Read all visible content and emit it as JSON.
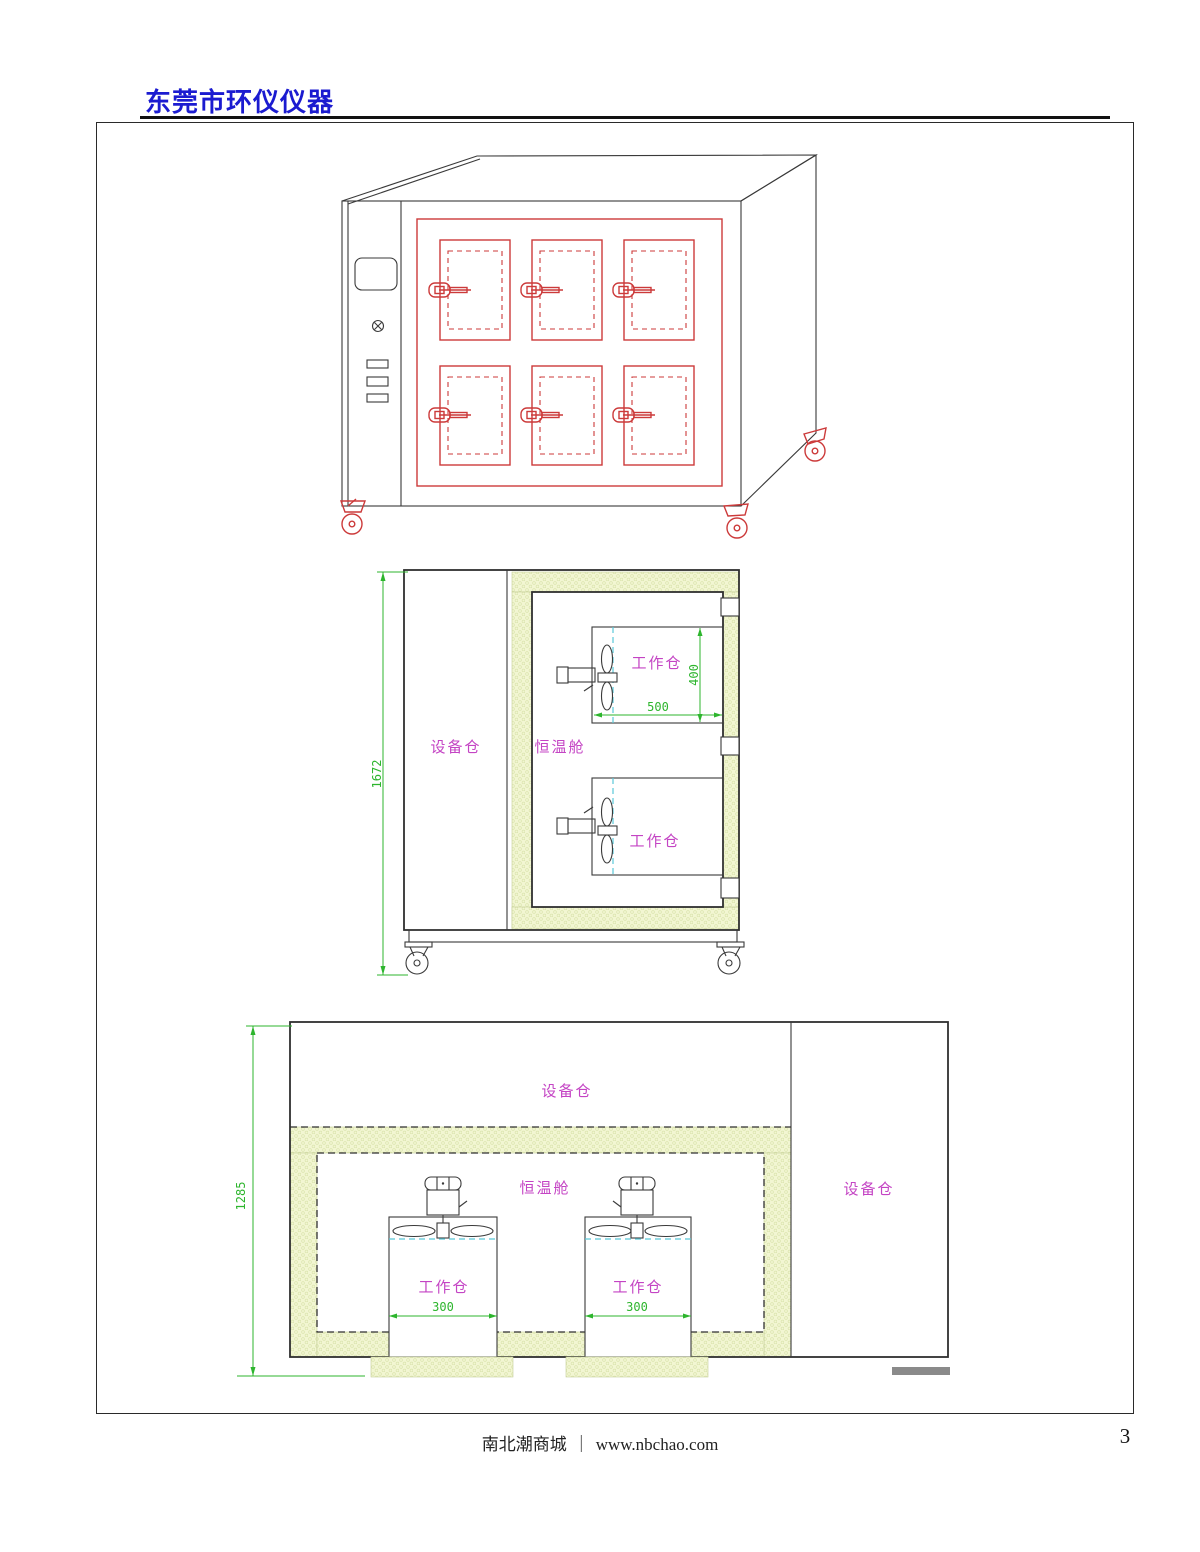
{
  "header": {
    "brand": "东莞市环仪仪器"
  },
  "side_section": {
    "dim_overall_height": "1672",
    "equipment_bay_label": "设备仓",
    "chamber_label": "恒温舱",
    "work_bay_top_label": "工作仓",
    "work_bay_bottom_label": "工作仓",
    "dim_work_width": "500",
    "dim_work_height": "400"
  },
  "front_section": {
    "dim_overall_height": "1285",
    "equipment_bay_top_label": "设备仓",
    "equipment_bay_right_label": "设备仓",
    "chamber_label": "恒温舱",
    "work_bay_left_label": "工作仓",
    "work_bay_right_label": "工作仓",
    "dim_work_left_width": "300",
    "dim_work_right_width": "300"
  },
  "footer": {
    "site_name": "南北潮商城",
    "divider": "｜",
    "site_url": "www.nbchao.com",
    "page_number": "3"
  },
  "colors": {
    "brand_blue": "#1b1bd0",
    "cad_red": "#cc3a3a",
    "cad_green": "#2db52d",
    "cad_magenta": "#c444c4",
    "cad_cyan": "#5ac8d8",
    "insulation_fill": "#f2f6d2"
  }
}
